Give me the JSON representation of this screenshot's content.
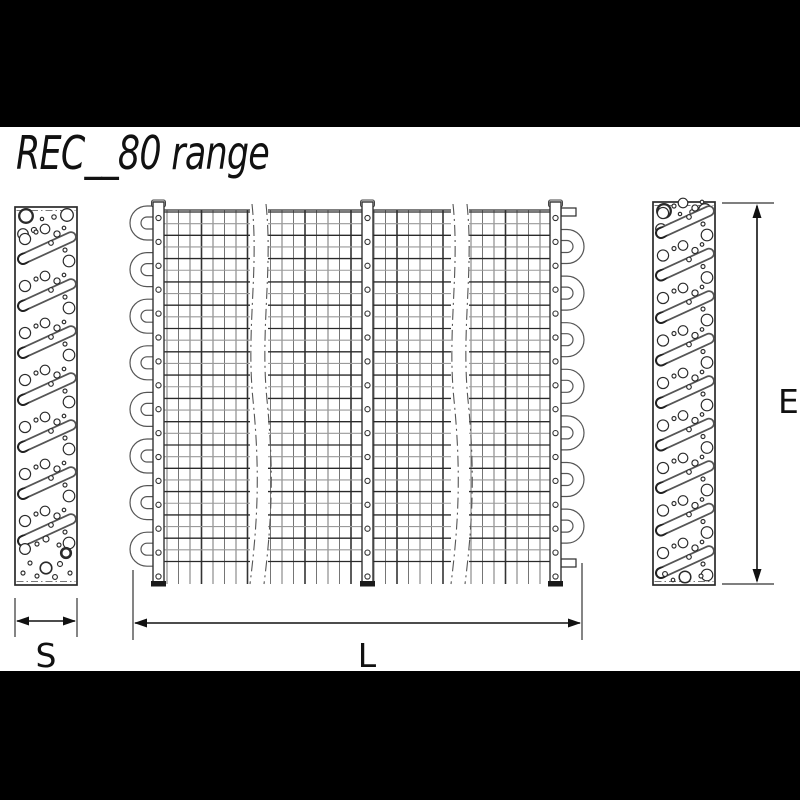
{
  "title": "REC__80 range",
  "dimensions": {
    "side_depth": "S",
    "finned_length": "L",
    "fin_height": "E"
  },
  "colors": {
    "letterbox": "#000000",
    "background": "#ffffff",
    "line_dark": "#2a2a2a",
    "line_medium": "#555555",
    "line_light": "#9a9a9a",
    "hatch_gray": "#777777"
  }
}
